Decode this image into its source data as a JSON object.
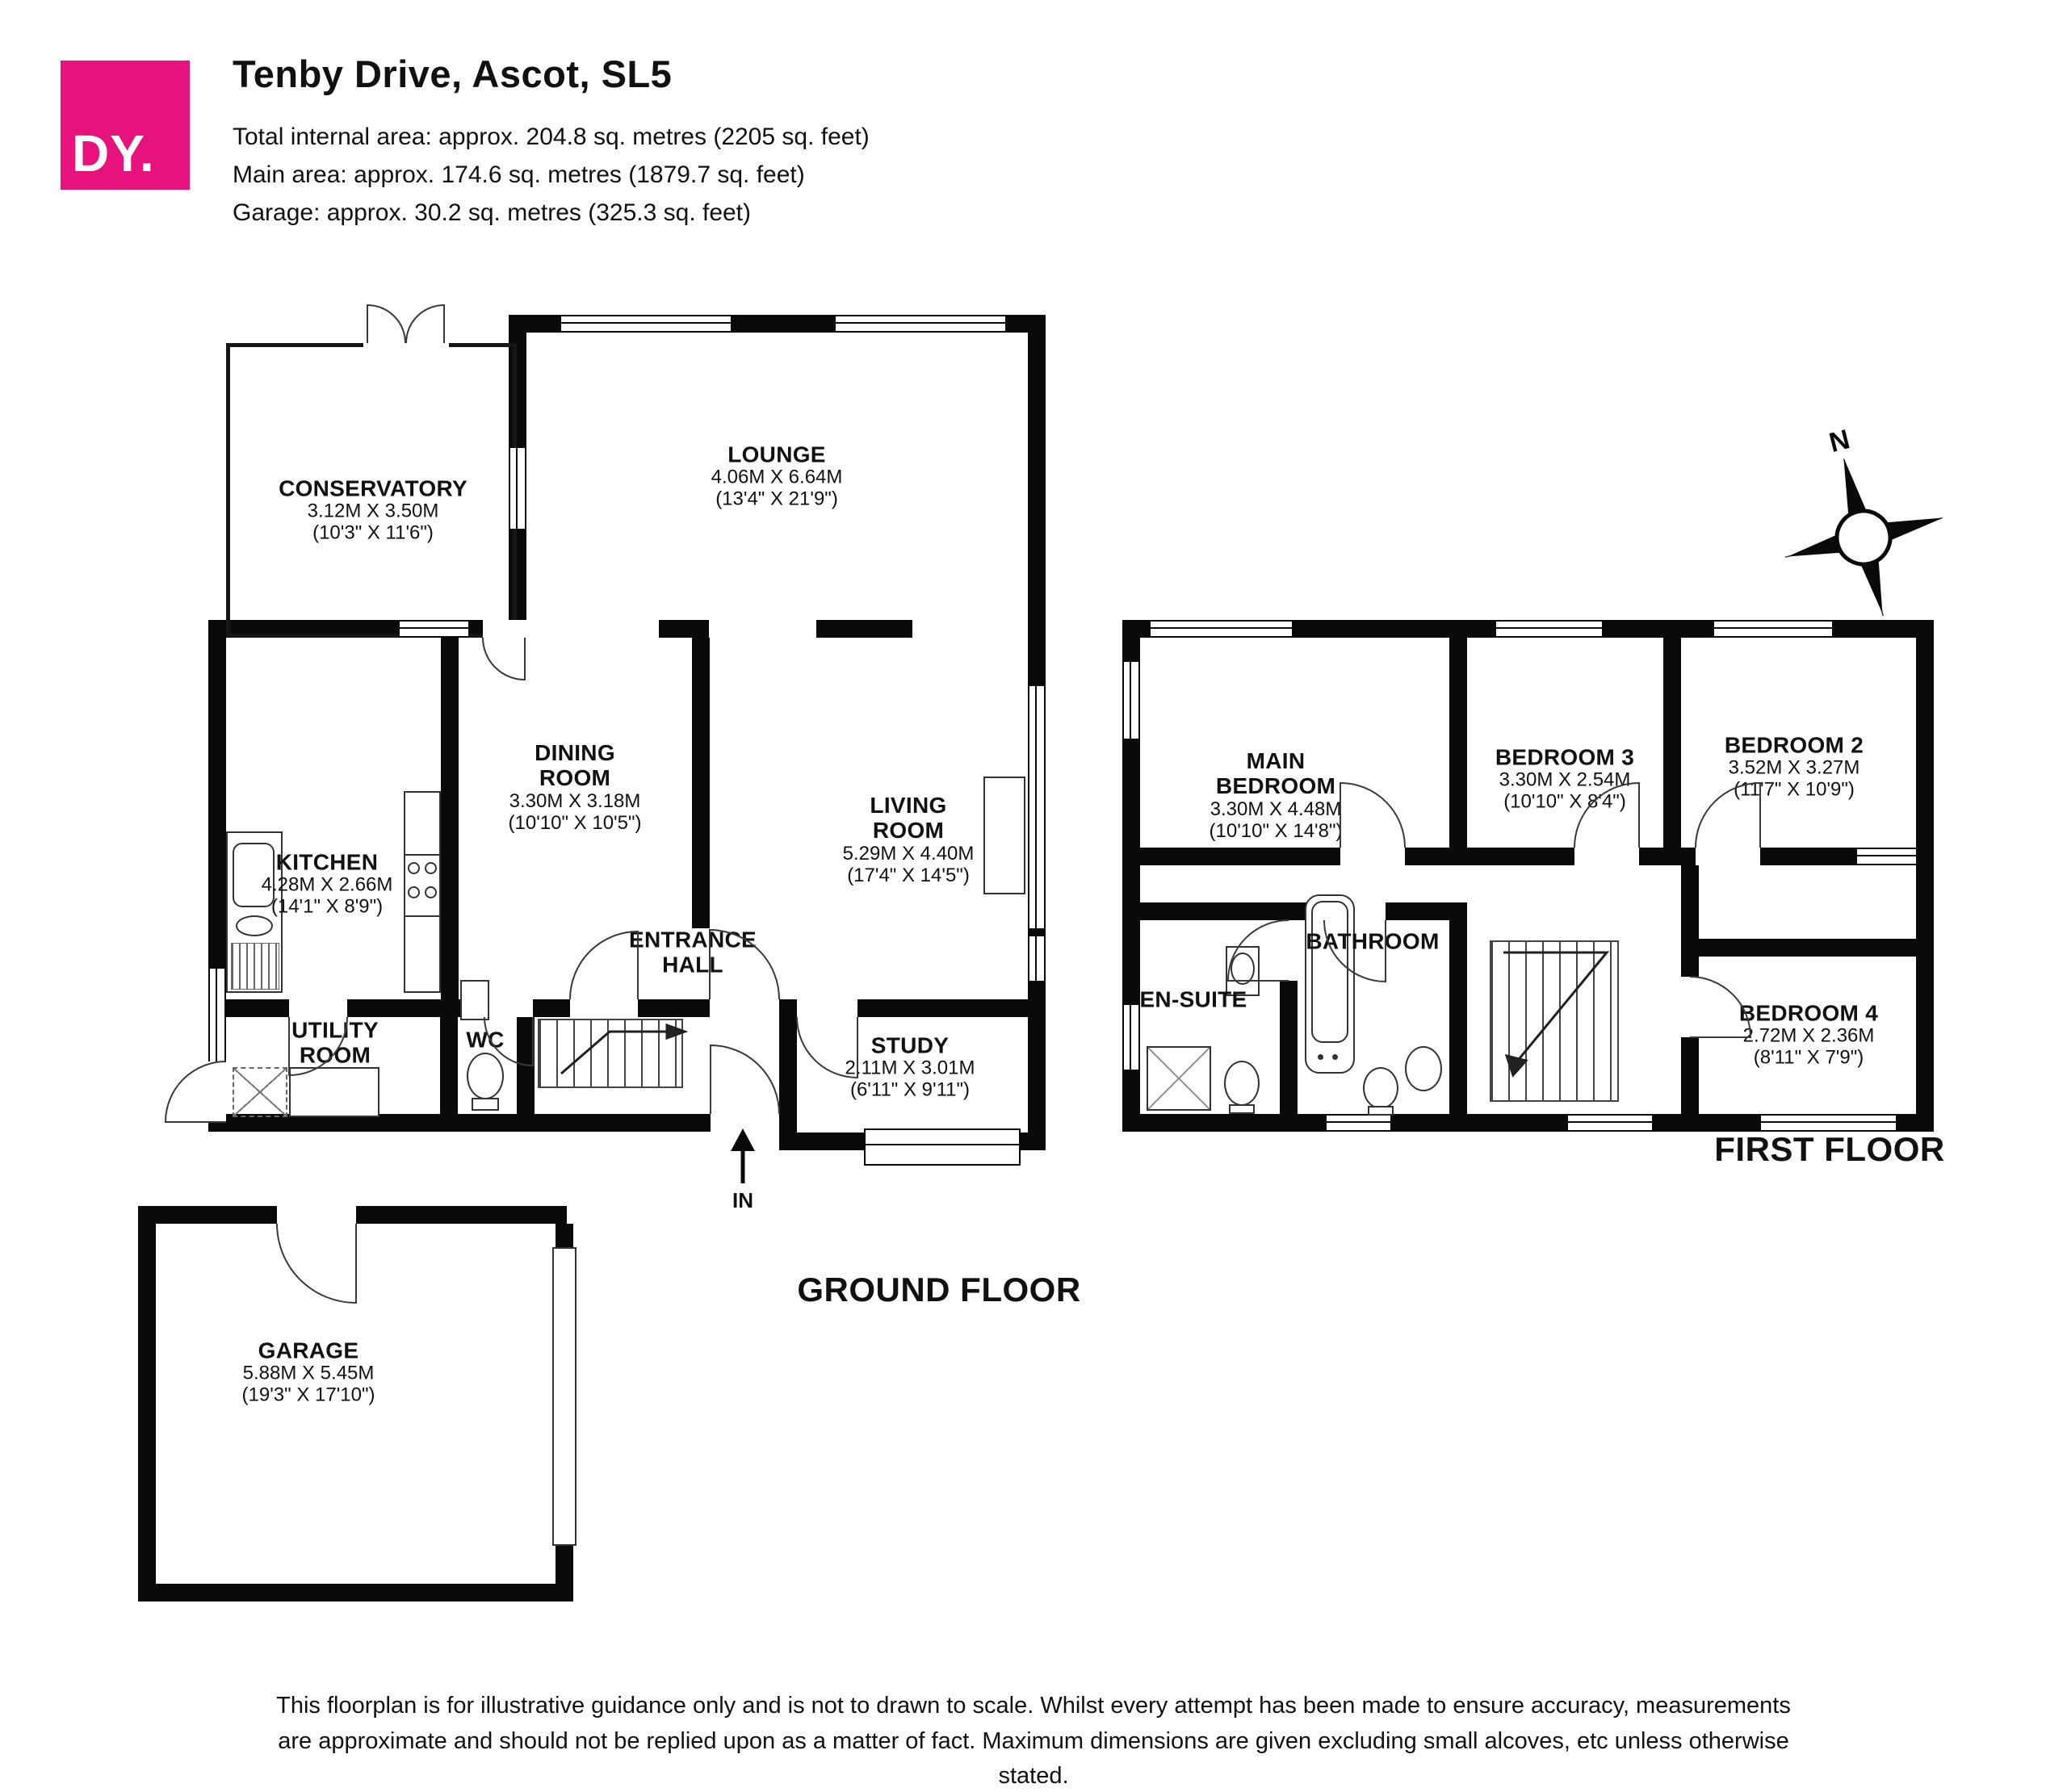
{
  "header": {
    "logo_text": "DY.",
    "title": "Tenby Drive, Ascot, SL5",
    "area_lines": [
      "Total internal area: approx. 204.8 sq. metres (2205 sq. feet)",
      "Main area: approx. 174.6 sq. metres (1879.7 sq. feet)",
      "Garage: approx. 30.2 sq. metres (325.3 sq. feet)"
    ]
  },
  "colors": {
    "brand_pink": "#E8127C",
    "wall_black": "#0A0A0A"
  },
  "floors": {
    "ground_caption": "GROUND FLOOR",
    "first_caption": "FIRST FLOOR"
  },
  "compass": {
    "north_label": "N"
  },
  "entrance": {
    "label": "IN"
  },
  "rooms": {
    "conservatory": {
      "name": "CONSERVATORY",
      "metric": "3.12M X 3.50M",
      "imperial": "(10'3\" X 11'6\")"
    },
    "lounge": {
      "name": "LOUNGE",
      "metric": "4.06M X 6.64M",
      "imperial": "(13'4\" X 21'9\")"
    },
    "kitchen": {
      "name": "KITCHEN",
      "metric": "4.28M X 2.66M",
      "imperial": "(14'1\" X 8'9\")"
    },
    "dining": {
      "name": "DINING ROOM",
      "metric": "3.30M X 3.18M",
      "imperial": "(10'10\" X 10'5\")"
    },
    "living": {
      "name": "LIVING ROOM",
      "metric": "5.29M X 4.40M",
      "imperial": "(17'4\" X 14'5\")"
    },
    "entrance_hall": {
      "name": "ENTRANCE HALL"
    },
    "utility": {
      "name": "UTILITY ROOM"
    },
    "wc": {
      "name": "WC"
    },
    "study": {
      "name": "STUDY",
      "metric": "2.11M X 3.01M",
      "imperial": "(6'11\" X 9'11\")"
    },
    "garage": {
      "name": "GARAGE",
      "metric": "5.88M X 5.45M",
      "imperial": "(19'3\" X 17'10\")"
    },
    "main_bedroom": {
      "name": "MAIN BEDROOM",
      "metric": "3.30M X 4.48M",
      "imperial": "(10'10\" X 14'8\")"
    },
    "bedroom3": {
      "name": "BEDROOM 3",
      "metric": "3.30M X 2.54M",
      "imperial": "(10'10\" X 8'4\")"
    },
    "bedroom2": {
      "name": "BEDROOM 2",
      "metric": "3.52M X 3.27M",
      "imperial": "(11'7\" X 10'9\")"
    },
    "bathroom": {
      "name": "BATHROOM"
    },
    "ensuite": {
      "name": "EN-SUITE"
    },
    "bedroom4": {
      "name": "BEDROOM 4",
      "metric": "2.72M X 2.36M",
      "imperial": "(8'11\" X 7'9\")"
    }
  },
  "disclaimer": "This floorplan is for illustrative guidance only and is not to drawn to scale. Whilst every attempt has been made to ensure accuracy, measurements are approximate and should not be replied upon as a matter of fact. Maximum dimensions are given excluding small alcoves, etc unless otherwise stated."
}
